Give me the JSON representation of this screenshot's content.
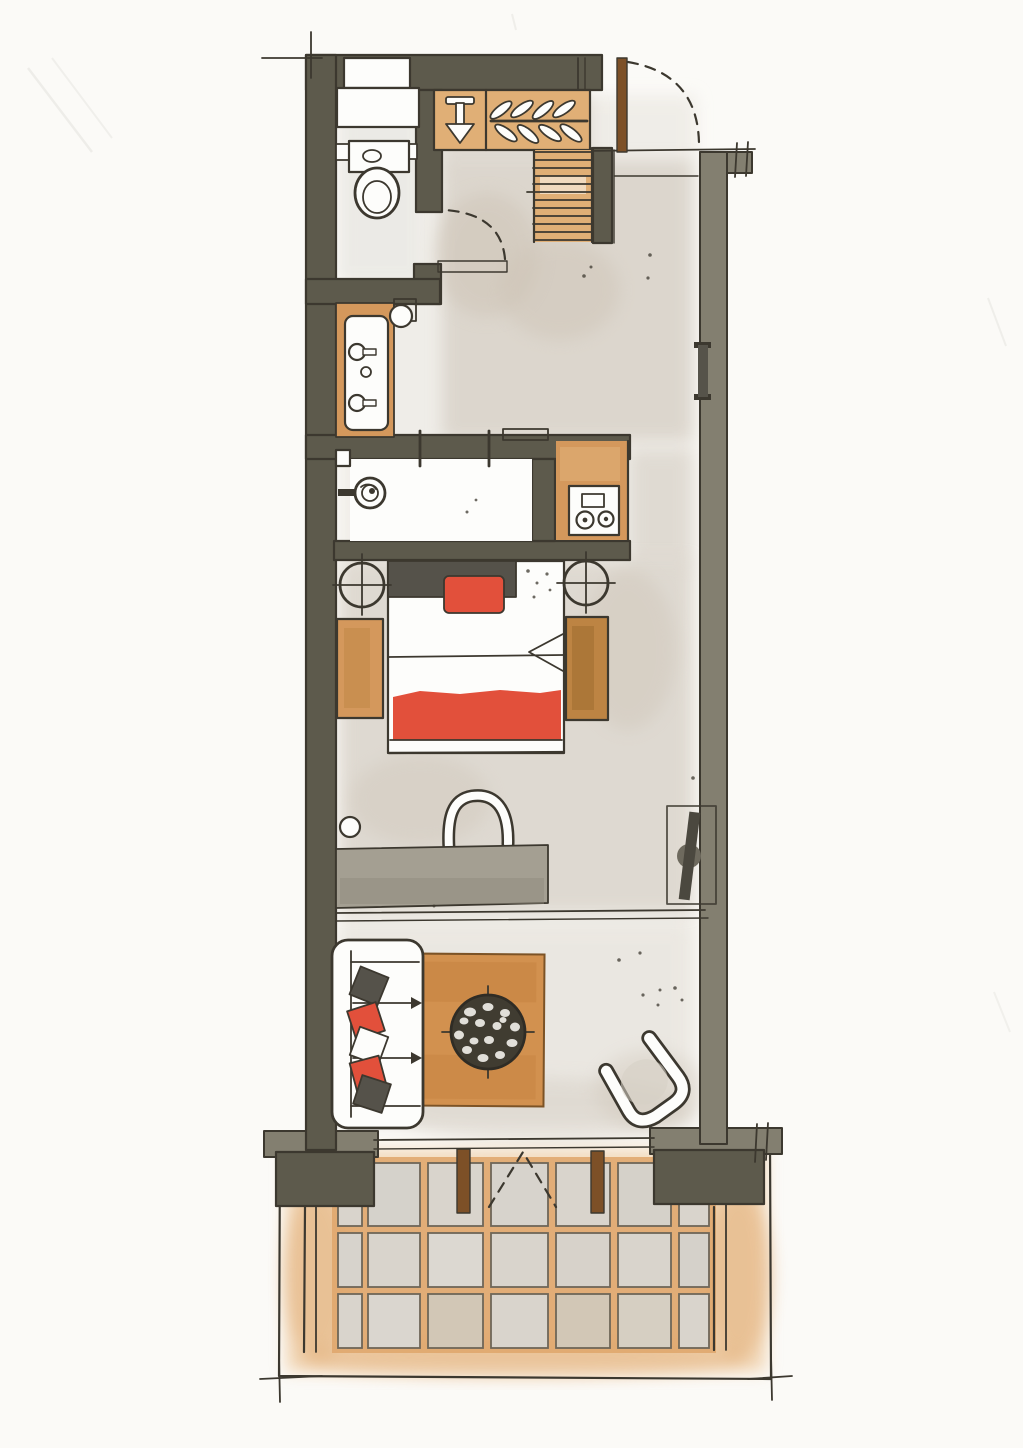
{
  "document": {
    "kind": "hand-drawn watercolor floor plan",
    "style": "ink and watercolor sketch",
    "orientation": "portrait"
  },
  "palette": {
    "paper": "#fbfaf7",
    "paper_white": "#fdfdfb",
    "ink": "#3c382f",
    "wall_dark": "#5d5a4c",
    "wall_mid": "#837f70",
    "wash_gray": "#d6cfc5",
    "wash_warm": "#cdc3b5",
    "wash_light": "#e7e3dc",
    "wood": "#d4985c",
    "wood_light": "#e0af76",
    "wood_dark": "#bd8443",
    "door_brown": "#7d5027",
    "red": "#e2503b",
    "desk_gray": "#a49f92",
    "cushion_gray": "#55524a",
    "table_dark": "#403c31",
    "pebble": "#efede8",
    "terrace_grout": "#dfa66b",
    "terrace_wash": "#ecc291",
    "tile": "#d9d4cc",
    "tile_warm": "#d2c7b6"
  },
  "rooms": [
    {
      "id": "wc",
      "label": "wc"
    },
    {
      "id": "closet",
      "label": "wardrobe closet"
    },
    {
      "id": "stairs",
      "label": "stairs"
    },
    {
      "id": "entry",
      "label": "entry hall"
    },
    {
      "id": "vanity",
      "label": "vanity alcove"
    },
    {
      "id": "shower",
      "label": "walk-in shower"
    },
    {
      "id": "kitchenette",
      "label": "kitchenette"
    },
    {
      "id": "bedroom",
      "label": "bedroom"
    },
    {
      "id": "workspace",
      "label": "desk area"
    },
    {
      "id": "living",
      "label": "living area"
    },
    {
      "id": "terrace",
      "label": "terrace"
    }
  ],
  "furniture": [
    "shelf-unit",
    "toilet",
    "washbasin-vanity",
    "wall-mirror",
    "shower-head",
    "wardrobe-hangers",
    "valet-hook",
    "staircase",
    "entry-door",
    "wc-door",
    "cooktop",
    "double-bed",
    "red-pillow",
    "red-blanket",
    "nightstand",
    "bedside-bench",
    "radiator",
    "desk",
    "desk-chair",
    "tv-console",
    "sofa",
    "sofa-cushions",
    "rug",
    "mosaic-coffee-table",
    "armchair",
    "terrace-doors",
    "terrace-tiles",
    "railing"
  ]
}
